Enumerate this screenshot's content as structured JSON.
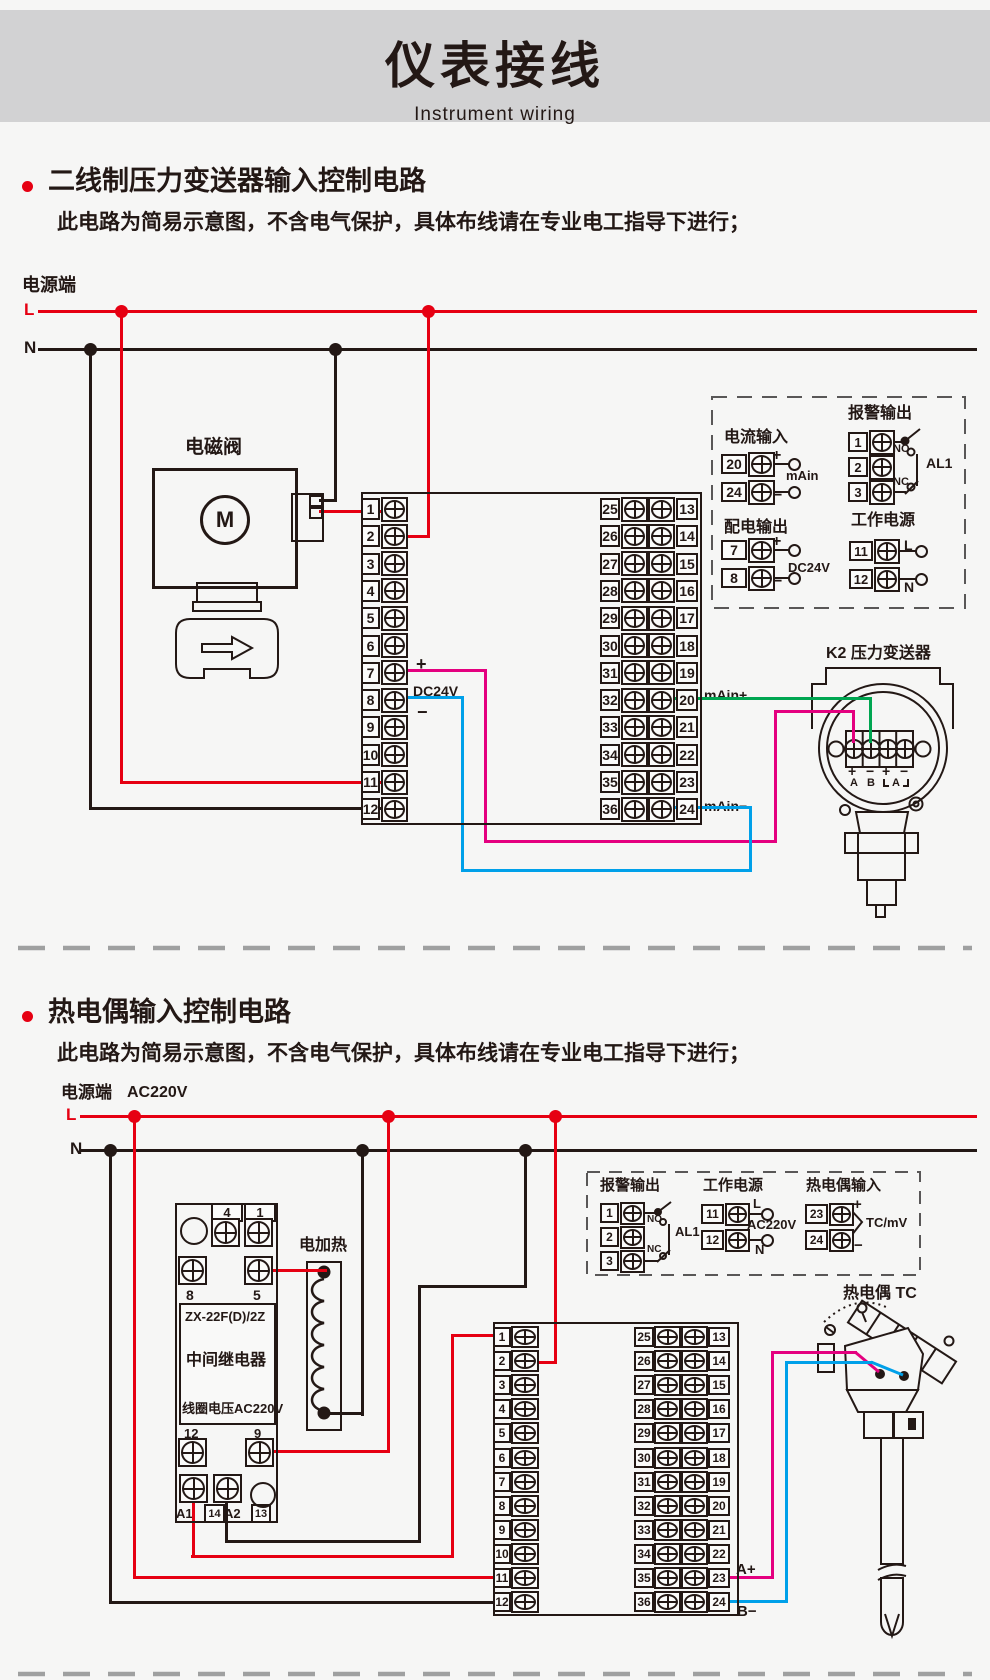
{
  "colors": {
    "red": "#e60012",
    "line": "#231815",
    "green": "#00a651",
    "magenta": "#e4007f",
    "blue": "#00a0e9",
    "banner_grey": "#d2d2d3",
    "dash_grey": "#595757",
    "divider_grey": "#9fa0a0"
  },
  "header": {
    "title": "仪表接线",
    "subtitle": "Instrument wiring"
  },
  "section1": {
    "heading": "二线制压力变送器输入控制电路",
    "note": "此电路为简易示意图，不含电气保护，具体布线请在专业电工指导下进行；"
  },
  "section2": {
    "heading": "热电偶输入控制电路",
    "note": "此电路为简易示意图，不含电气保护，具体布线请在专业电工指导下进行；"
  },
  "diagram1": {
    "power_label": "电源端",
    "l": "L",
    "n": "N",
    "valve_label": "电磁阀",
    "motor": "M",
    "plus": "+",
    "minus": "−",
    "dc24v": "DC24V",
    "main_plus": "mAin+",
    "main_minus": "mAin−",
    "terminals_left": [
      "1",
      "2",
      "3",
      "4",
      "5",
      "6",
      "7",
      "8",
      "9",
      "10",
      "11",
      "12"
    ],
    "terminals_mid": [
      "25",
      "26",
      "27",
      "28",
      "29",
      "30",
      "31",
      "32",
      "33",
      "34",
      "35",
      "36"
    ],
    "terminals_right": [
      "13",
      "14",
      "15",
      "16",
      "17",
      "18",
      "19",
      "20",
      "21",
      "22",
      "23",
      "24"
    ],
    "panel": {
      "current": {
        "title": "电流输入",
        "t_top": "20",
        "t_bot": "24",
        "plus": "+",
        "minus": "−",
        "label": "mAin"
      },
      "alarm": {
        "title": "报警输出",
        "t1": "1",
        "t2": "2",
        "t3": "3",
        "no": "NO",
        "nc": "NC",
        "al": "AL1"
      },
      "dist": {
        "title": "配电输出",
        "t_top": "7",
        "t_bot": "8",
        "plus": "+",
        "minus": "−",
        "label": "DC24V"
      },
      "work": {
        "title": "工作电源",
        "t_top": "11",
        "t_bot": "12",
        "l": "L",
        "n": "N"
      }
    },
    "transmitter": {
      "label": "K2 压力变送器",
      "p1": "+",
      "m1": "−",
      "p2": "+",
      "m2": "−",
      "a": "A",
      "b": "B",
      "a2": "A"
    }
  },
  "diagram2": {
    "power_label": "电源端",
    "voltage": "AC220V",
    "l": "L",
    "n": "N",
    "relay": {
      "t4": "4",
      "t1": "1",
      "t8": "8",
      "t5": "5",
      "model": "ZX-22F(D)/2Z",
      "name": "中间继电器",
      "coil": "线圈电压AC220V",
      "t12": "12",
      "t9": "9",
      "a1": "A1",
      "n14": "14",
      "a2": "A2",
      "n13": "13"
    },
    "heater_label": "电加热",
    "panel": {
      "alarm": {
        "title": "报警输出",
        "t1": "1",
        "t2": "2",
        "t3": "3",
        "no": "NO",
        "nc": "NC",
        "al": "AL1"
      },
      "work": {
        "title": "工作电源",
        "t_top": "11",
        "t_bot": "12",
        "l": "L",
        "n": "N",
        "label": "AC220V"
      },
      "tc": {
        "title": "热电偶输入",
        "t_top": "23",
        "t_bot": "24",
        "plus": "+",
        "minus": "−",
        "label": "TC/mV"
      }
    },
    "tc_label": "热电偶 TC",
    "a_plus": "A+",
    "b_minus": "B−",
    "terminals_left": [
      "1",
      "2",
      "3",
      "4",
      "5",
      "6",
      "7",
      "8",
      "9",
      "10",
      "11",
      "12"
    ],
    "terminals_mid": [
      "25",
      "26",
      "27",
      "28",
      "29",
      "30",
      "31",
      "32",
      "33",
      "34",
      "35",
      "36"
    ],
    "terminals_right": [
      "13",
      "14",
      "15",
      "16",
      "17",
      "18",
      "19",
      "20",
      "21",
      "22",
      "23",
      "24"
    ]
  }
}
